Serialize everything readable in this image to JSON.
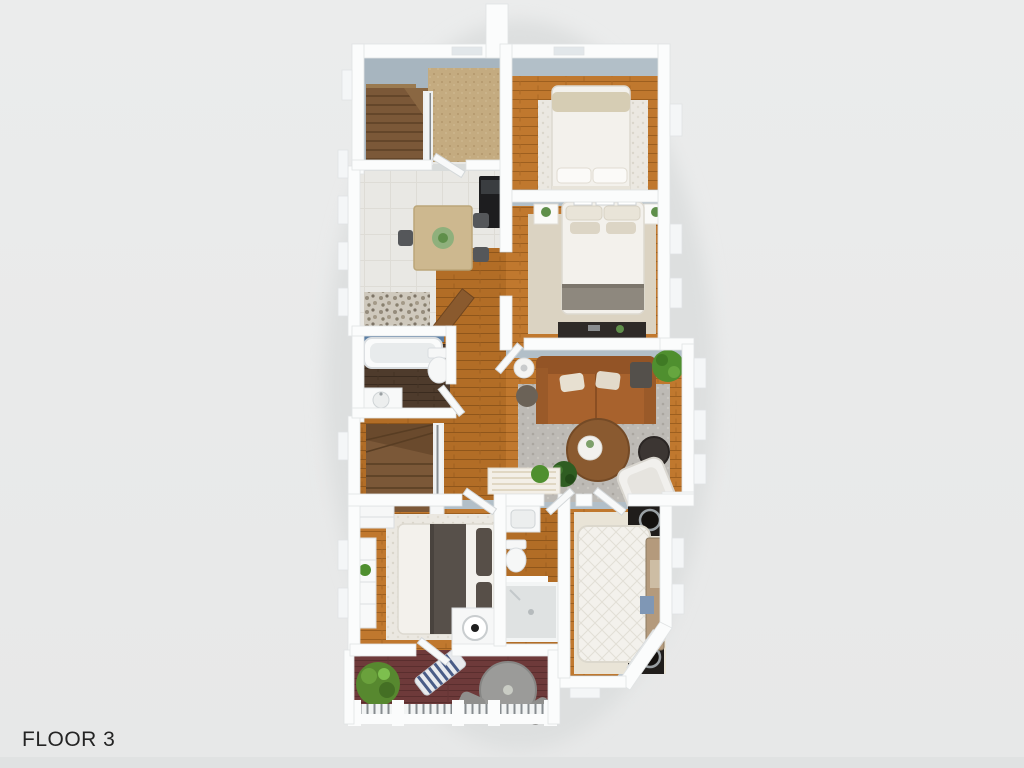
{
  "page": {
    "background_color": "#e9eaea",
    "floor_label": "FLOOR 3"
  },
  "floorplan": {
    "kind": "3d-top-down-floor-plan-render",
    "floor_label": "FLOOR 3",
    "palette": {
      "background": "#e9eaea",
      "wall_white": "#fbfcfc",
      "wall_inner_face_blue_gray": "#b2bfc8",
      "wood_floor_orange": "#c0782e",
      "bathroom_dark_wood": "#4e3b2c",
      "kitchen_light_floor": "#e9e8e4",
      "deck_burgundy": "#6e3a3a",
      "stair_carpet_tan": "#c4ab80",
      "rug_white_shag": "#ebe8e1",
      "rug_gray_shag": "#bdbab5",
      "rug_beige": "#dbd3c2",
      "sofa_leather_brown": "#a8622d",
      "bed_linen_white": "#f3f1ec",
      "blanket_dark_gray": "#57504a",
      "blanket_beige": "#d6cdb4",
      "speaker_black": "#201d1b",
      "plant_green": "#4f8f2f",
      "tub_tile_blue": "#5b7ea3"
    },
    "rooms": [
      {
        "name": "stairwell-top",
        "furniture": [
          "staircase",
          "stair-railing",
          "carpet-landing"
        ]
      },
      {
        "name": "bedroom-top-right",
        "furniture": [
          "double-bed",
          "white-shag-rug",
          "window"
        ]
      },
      {
        "name": "dining-kitchen",
        "furniture": [
          "dining-table",
          "plant-centerpiece",
          "dining-chairs",
          "black-appliance",
          "pebble-mat"
        ]
      },
      {
        "name": "bedroom-middle-right",
        "furniture": [
          "double-bed",
          "nightstand-left",
          "nightstand-right",
          "wall-frames",
          "beige-rug",
          "dark-dresser"
        ]
      },
      {
        "name": "bathroom-upper",
        "furniture": [
          "bathtub",
          "toilet",
          "vanity-sink"
        ]
      },
      {
        "name": "hallway-stairs",
        "furniture": [
          "staircase-down",
          "stair-railing",
          "open-wood-door"
        ]
      },
      {
        "name": "living-room",
        "furniture": [
          "leather-sofa",
          "throw-pillows",
          "floor-lamp",
          "pouf",
          "gray-shag-rug",
          "round-coffee-table",
          "dark-side-table",
          "white-lounge-chair",
          "potted-plant",
          "floor-plant",
          "console-table"
        ]
      },
      {
        "name": "bedroom-bottom-left",
        "furniture": [
          "double-bed",
          "white-rug",
          "white-dresser",
          "dresser-plant",
          "lamp-table",
          "closet"
        ]
      },
      {
        "name": "bathroom-lower",
        "furniture": [
          "vanity-sink",
          "toilet",
          "shower"
        ]
      },
      {
        "name": "bedroom-bottom-right",
        "furniture": [
          "quilted-bed",
          "headboard-bench",
          "speaker-top",
          "speaker-bottom",
          "cream-rug",
          "bay-window"
        ]
      },
      {
        "name": "deck",
        "furniture": [
          "shrub",
          "striped-lounger",
          "round-patio-table",
          "patio-chairs",
          "deck-railing"
        ]
      }
    ]
  }
}
